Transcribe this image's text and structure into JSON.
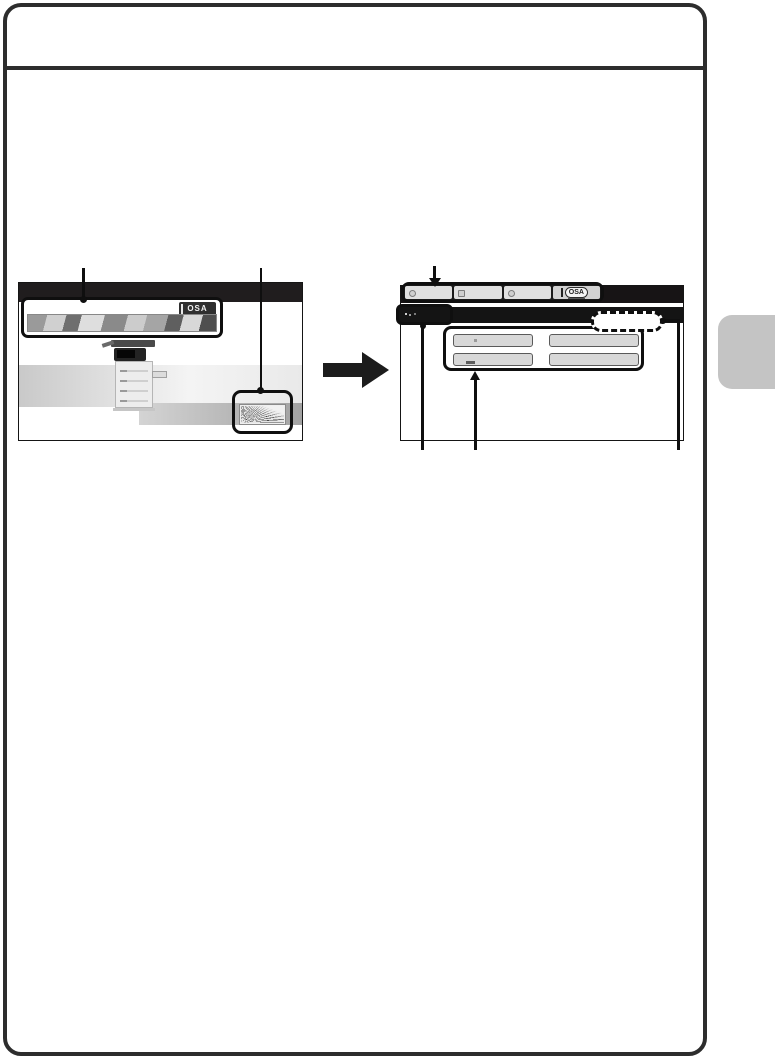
{
  "page": {
    "frame_color": "#2d2d2d",
    "side_tab_color": "#c4c4c4",
    "background_color": "#ffffff",
    "callout_color": "#0f0f0f"
  },
  "figure": {
    "before_screen": {
      "top_bar_color": "#201d1e",
      "banner": {
        "osa_logo": "OSA"
      }
    },
    "transition_arrow_icon": "right-arrow",
    "after_screen": {
      "top_bar_color": "#171415",
      "title_bar_color": "#141414",
      "tab_bar": {
        "tabs": [
          {
            "icon": "copy-tab-icon",
            "label": ""
          },
          {
            "icon": "send-tab-icon",
            "label": ""
          },
          {
            "icon": "filing-tab-icon",
            "label": ""
          },
          {
            "icon": "osa-tab-logo",
            "label": "OSA"
          }
        ]
      },
      "buttons": [
        {
          "label": ""
        },
        {
          "label": ""
        },
        {
          "label": ""
        },
        {
          "label": ""
        }
      ]
    }
  }
}
